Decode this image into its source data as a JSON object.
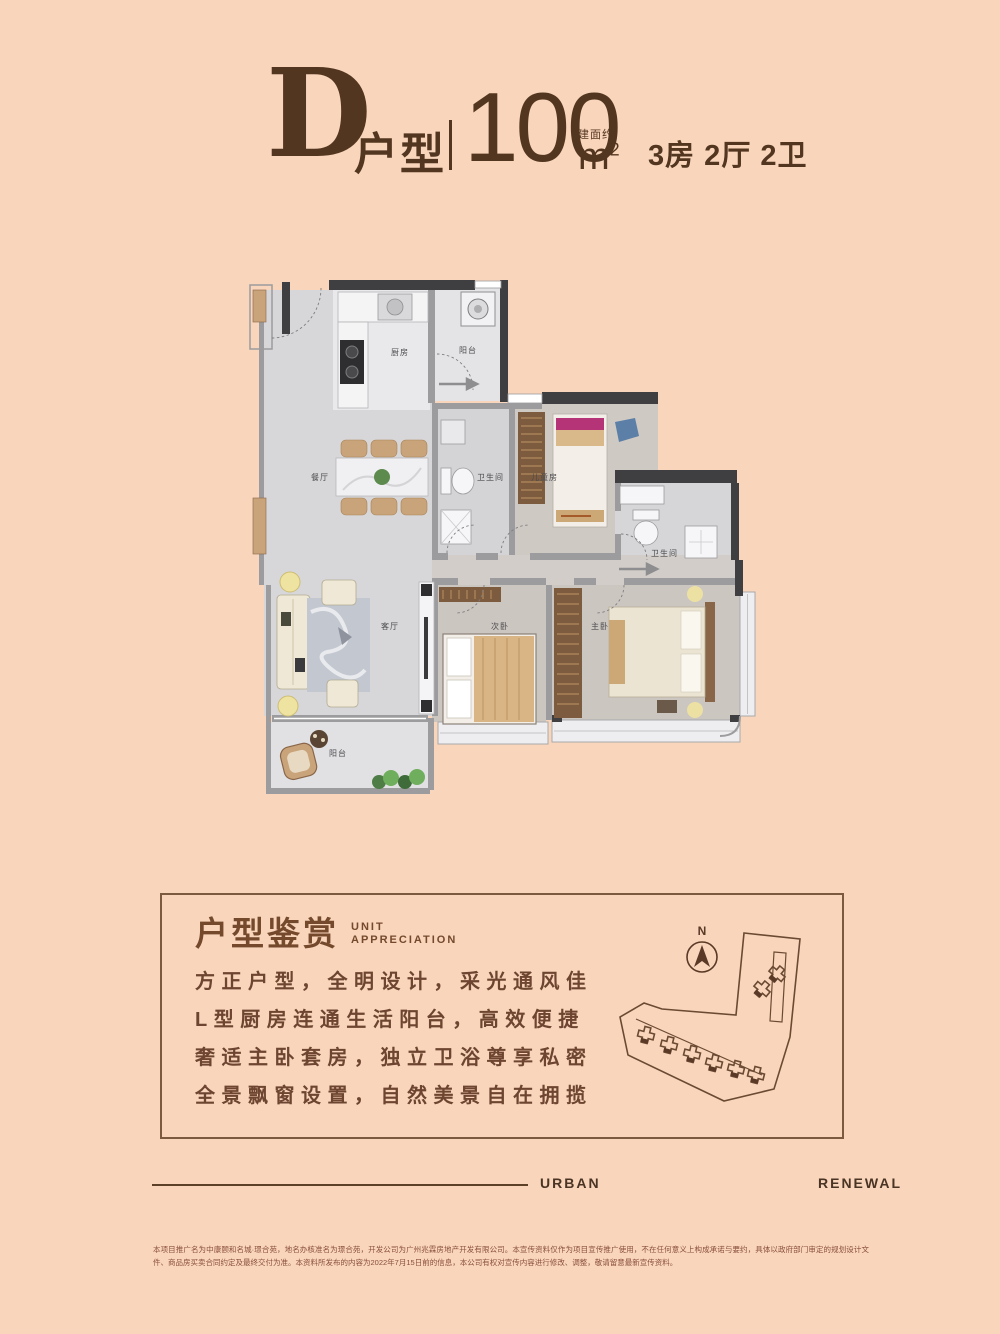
{
  "colors": {
    "background": "#f8d5bb",
    "ink_dark_brown": "#533620",
    "body_brown": "#6d4530",
    "box_border": "#7b5a40",
    "disclaimer_brown": "#8a4f3c",
    "wall_dark": "#3f3f41",
    "wall_gray": "#9c9c9e",
    "floor_gray": "#d7d7d9",
    "furniture_tan": "#c9a47a",
    "wardrobe_brown": "#7d5b3e",
    "accent_magenta": "#b53377"
  },
  "header": {
    "unit_letter": "D",
    "unit_type_suffix": "户型",
    "area_approx_label": "建面约",
    "area_value": "100",
    "area_unit_m": "m",
    "area_unit_sup": "2",
    "layout_spec": "3房 2厅 2卫"
  },
  "floorplan": {
    "labels": {
      "kitchen": "厨房",
      "balcony_top": "阳台",
      "dining": "餐厅",
      "bath_main": "卫生间",
      "kids_room": "儿童房",
      "bath_master": "卫生间",
      "living": "客厅",
      "bedroom_second": "次卧",
      "bedroom_master": "主卧",
      "balcony_bottom": "阳台"
    }
  },
  "appreciation": {
    "title_cn": "户型鉴赏",
    "title_en_line1": "UNIT",
    "title_en_line2": "APPRECIATION",
    "features": [
      "方正户型，全明设计，采光通风佳",
      "L型厨房连通生活阳台，高效便捷",
      "奢适主卧套房，独立卫浴尊享私密",
      "全景飘窗设置，自然美景自在拥揽"
    ]
  },
  "sitemap": {
    "north_label": "N"
  },
  "footer": {
    "slogan_left": "URBAN",
    "slogan_right": "RENEWAL",
    "disclaimer": "本项目推广名为中康颐和名城·璟合苑，地名办核准名为璟合苑，开发公司为广州兆霖房地产开发有限公司。本宣传资料仅作为项目宣传推广使用，不在任何意义上构成承诺与要约，具体以政府部门审定的规划设计文件、商品房买卖合同约定及最终交付为准。本资料所发布的内容为2022年7月15日前的信息，本公司有权对宣传内容进行修改、调整，敬请留意最新宣传资料。"
  }
}
